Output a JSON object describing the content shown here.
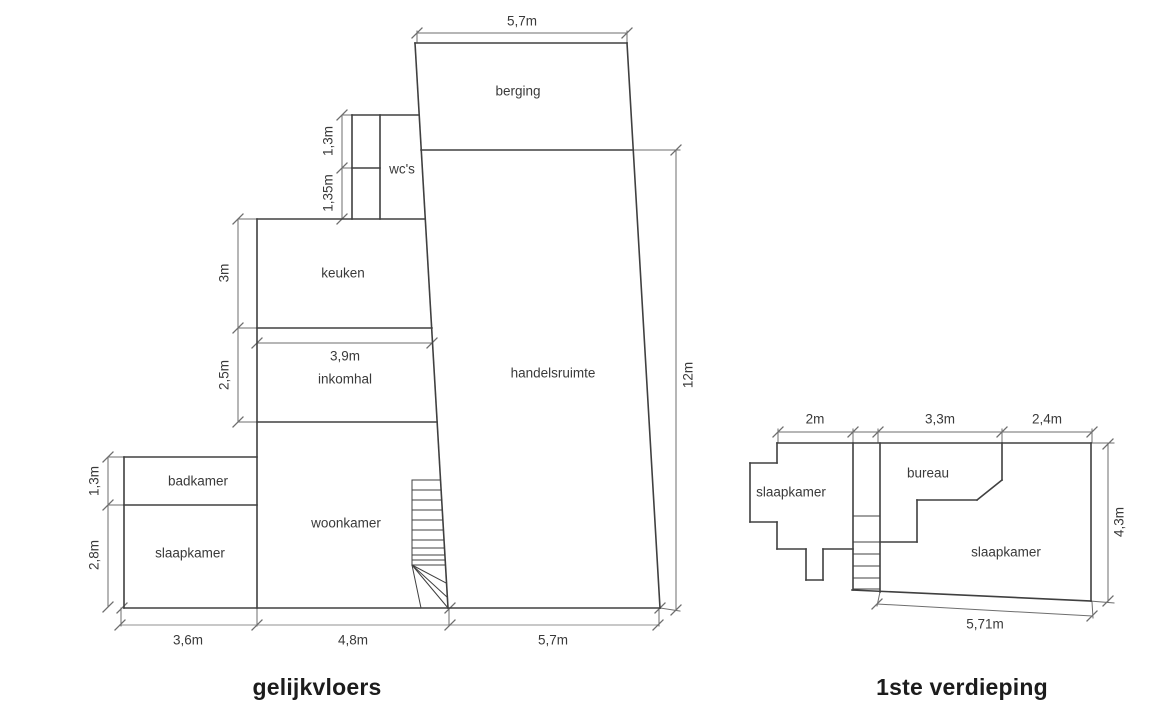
{
  "page": {
    "background": "#ffffff",
    "wall_color": "#404040",
    "dim_color": "#6e6e6e",
    "dim_light_color": "#a6a6a6",
    "text_color": "#3a3a3a",
    "title_color": "#1c1c1c"
  },
  "plans": [
    {
      "name": "gelijkvloers",
      "title": "gelijkvloers",
      "walls": [
        [
          415,
          43,
          627,
          43
        ],
        [
          627,
          43,
          660,
          608
        ],
        [
          124,
          608,
          660,
          608
        ],
        [
          124,
          457,
          124,
          608
        ],
        [
          124,
          457,
          257,
          457
        ],
        [
          124,
          505,
          257,
          505
        ],
        [
          257,
          219,
          257,
          608
        ],
        [
          257,
          219,
          425,
          219
        ],
        [
          257,
          328,
          432,
          328
        ],
        [
          257,
          422,
          437,
          422
        ],
        [
          352,
          115,
          419,
          115
        ],
        [
          352,
          115,
          352,
          219
        ],
        [
          380,
          115,
          380,
          219
        ],
        [
          352,
          168,
          380,
          168
        ],
        [
          415,
          43,
          448,
          608
        ],
        [
          421,
          150,
          633,
          150
        ]
      ],
      "stairs": [
        [
          412,
          480,
          412,
          565
        ],
        [
          412,
          480,
          440,
          480
        ],
        [
          412,
          490,
          441,
          490
        ],
        [
          412,
          500,
          442,
          500
        ],
        [
          412,
          510,
          442,
          510
        ],
        [
          412,
          520,
          443,
          520
        ],
        [
          412,
          530,
          443,
          530
        ],
        [
          412,
          540,
          444,
          540
        ],
        [
          412,
          548,
          444,
          548
        ],
        [
          412,
          555,
          445,
          555
        ],
        [
          412,
          560,
          445,
          560
        ],
        [
          412,
          565,
          445,
          565
        ],
        [
          412,
          565,
          421,
          608
        ],
        [
          412,
          565,
          446,
          583
        ],
        [
          412,
          565,
          447,
          597
        ],
        [
          412,
          565,
          448,
          608
        ]
      ],
      "dim_lines": [
        [
          417,
          33,
          627,
          33
        ],
        [
          676,
          150,
          676,
          610
        ],
        [
          342,
          115,
          342,
          219
        ],
        [
          238,
          219,
          238,
          422
        ],
        [
          257,
          343,
          432,
          343
        ],
        [
          108,
          457,
          108,
          607
        ]
      ],
      "dim_lines_light": [
        [
          120,
          625,
          658,
          625
        ]
      ],
      "ext_lines": [
        [
          417,
          43,
          417,
          31
        ],
        [
          627,
          43,
          627,
          31
        ],
        [
          633,
          150,
          680,
          150
        ],
        [
          660,
          608,
          680,
          611
        ],
        [
          342,
          115,
          352,
          115
        ],
        [
          342,
          168,
          352,
          168
        ],
        [
          238,
          219,
          257,
          219
        ],
        [
          238,
          328,
          257,
          328
        ],
        [
          238,
          422,
          257,
          422
        ],
        [
          108,
          457,
          124,
          457
        ],
        [
          108,
          505,
          124,
          505
        ],
        [
          121,
          608,
          121,
          626
        ],
        [
          257,
          608,
          257,
          626
        ],
        [
          449,
          608,
          449,
          626
        ],
        [
          659,
          608,
          659,
          626
        ]
      ],
      "ticks": [
        [
          417,
          33
        ],
        [
          627,
          33
        ],
        [
          676,
          150
        ],
        [
          676,
          610
        ],
        [
          342,
          115
        ],
        [
          342,
          168
        ],
        [
          342,
          219
        ],
        [
          238,
          219
        ],
        [
          238,
          328
        ],
        [
          238,
          422
        ],
        [
          257,
          343
        ],
        [
          432,
          343
        ],
        [
          108,
          457
        ],
        [
          108,
          505
        ],
        [
          108,
          607
        ],
        [
          120,
          625
        ],
        [
          257,
          625
        ],
        [
          450,
          625
        ],
        [
          658,
          625
        ],
        [
          122,
          608
        ],
        [
          450,
          608
        ],
        [
          660,
          608
        ]
      ],
      "room_labels": [
        {
          "text": "berging",
          "x": 518,
          "y": 92
        },
        {
          "text": "wc's",
          "x": 402,
          "y": 170
        },
        {
          "text": "keuken",
          "x": 343,
          "y": 274
        },
        {
          "text": "inkomhal",
          "x": 345,
          "y": 380
        },
        {
          "text": "handelsruimte",
          "x": 553,
          "y": 374
        },
        {
          "text": "badkamer",
          "x": 198,
          "y": 482
        },
        {
          "text": "slaapkamer",
          "x": 190,
          "y": 554
        },
        {
          "text": "woonkamer",
          "x": 346,
          "y": 524
        }
      ],
      "dim_labels": [
        {
          "text": "5,7m",
          "x": 522,
          "y": 22,
          "rot": false
        },
        {
          "text": "12m",
          "x": 689,
          "y": 375,
          "rot": true
        },
        {
          "text": "1,3m",
          "x": 329,
          "y": 141,
          "rot": true
        },
        {
          "text": "1,35m",
          "x": 329,
          "y": 193,
          "rot": true
        },
        {
          "text": "3m",
          "x": 225,
          "y": 273,
          "rot": true
        },
        {
          "text": "2,5m",
          "x": 225,
          "y": 375,
          "rot": true
        },
        {
          "text": "3,9m",
          "x": 345,
          "y": 357,
          "rot": false
        },
        {
          "text": "1,3m",
          "x": 95,
          "y": 481,
          "rot": true
        },
        {
          "text": "2,8m",
          "x": 95,
          "y": 555,
          "rot": true
        },
        {
          "text": "3,6m",
          "x": 188,
          "y": 641,
          "rot": false
        },
        {
          "text": "4,8m",
          "x": 353,
          "y": 641,
          "rot": false
        },
        {
          "text": "5,7m",
          "x": 553,
          "y": 641,
          "rot": false
        }
      ]
    },
    {
      "name": "1ste-verdieping",
      "title": "1ste verdieping",
      "walls": [
        [
          777,
          443,
          1091,
          443
        ],
        [
          1091,
          443,
          1091,
          601
        ],
        [
          852,
          590,
          1091,
          601
        ],
        [
          853,
          443,
          853,
          590
        ],
        [
          880,
          443,
          880,
          592
        ],
        [
          777,
          443,
          777,
          463
        ],
        [
          750,
          463,
          777,
          463
        ],
        [
          750,
          463,
          750,
          522
        ],
        [
          750,
          522,
          777,
          522
        ],
        [
          777,
          522,
          777,
          549
        ],
        [
          777,
          549,
          806,
          549
        ],
        [
          806,
          549,
          806,
          580
        ],
        [
          806,
          580,
          823,
          580
        ],
        [
          823,
          549,
          823,
          580
        ],
        [
          823,
          549,
          853,
          549
        ],
        [
          880,
          542,
          917,
          542
        ],
        [
          917,
          500,
          917,
          542
        ],
        [
          917,
          500,
          977,
          500
        ],
        [
          977,
          500,
          1002,
          480
        ],
        [
          1002,
          443,
          1002,
          480
        ]
      ],
      "stairs": [
        [
          853,
          516,
          880,
          516
        ],
        [
          853,
          542,
          880,
          542
        ],
        [
          853,
          554,
          880,
          554
        ],
        [
          853,
          566,
          880,
          566
        ],
        [
          853,
          578,
          880,
          578
        ],
        [
          853,
          589,
          880,
          589
        ]
      ],
      "dim_lines": [
        [
          778,
          432,
          1092,
          432
        ],
        [
          1108,
          443,
          1108,
          602
        ],
        [
          877,
          604,
          1092,
          616
        ]
      ],
      "dim_lines_light": [],
      "ext_lines": [
        [
          778,
          443,
          778,
          429
        ],
        [
          853,
          443,
          853,
          429
        ],
        [
          878,
          443,
          878,
          429
        ],
        [
          1002,
          443,
          1002,
          429
        ],
        [
          1092,
          443,
          1092,
          429
        ],
        [
          1091,
          443,
          1114,
          443
        ],
        [
          1090,
          601,
          1114,
          603
        ],
        [
          880,
          592,
          877,
          606
        ],
        [
          1092,
          602,
          1093,
          618
        ]
      ],
      "ticks": [
        [
          778,
          432
        ],
        [
          853,
          432
        ],
        [
          878,
          432
        ],
        [
          1002,
          432
        ],
        [
          1092,
          432
        ],
        [
          1108,
          444
        ],
        [
          1108,
          601
        ],
        [
          877,
          604
        ],
        [
          1092,
          616
        ]
      ],
      "room_labels": [
        {
          "text": "slaapkamer",
          "x": 791,
          "y": 493
        },
        {
          "text": "bureau",
          "x": 928,
          "y": 474
        },
        {
          "text": "slaapkamer",
          "x": 1006,
          "y": 553
        }
      ],
      "dim_labels": [
        {
          "text": "2m",
          "x": 815,
          "y": 420,
          "rot": false
        },
        {
          "text": "3,3m",
          "x": 940,
          "y": 420,
          "rot": false
        },
        {
          "text": "2,4m",
          "x": 1047,
          "y": 420,
          "rot": false
        },
        {
          "text": "4,3m",
          "x": 1120,
          "y": 522,
          "rot": true
        },
        {
          "text": "5,71m",
          "x": 985,
          "y": 625,
          "rot": false
        }
      ]
    }
  ]
}
